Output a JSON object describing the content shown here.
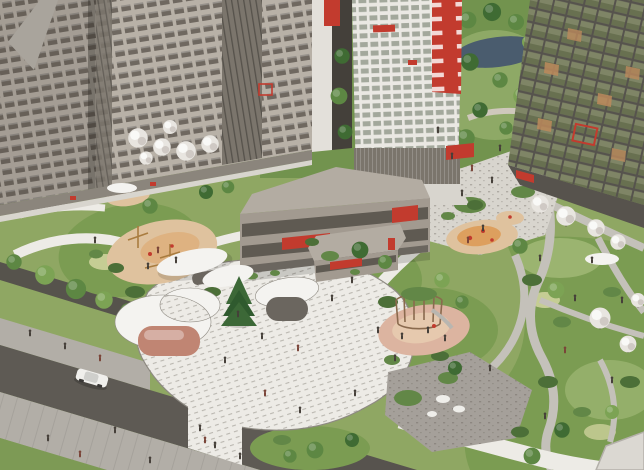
{
  "scene": {
    "label": "Aerial architectural rendering of a residential complex courtyard",
    "elements": [
      "apartment-building-left-cluster",
      "white-tower-with-red-accents",
      "glass-apartment-building-right",
      "parking-podium-building",
      "park-with-lake",
      "courtyard-plaza",
      "sand-playground",
      "orange-playground",
      "climbing-dome-playground",
      "crescent-canopy",
      "white-canopies",
      "pink-pavilion",
      "spruce-tree",
      "blossom-trees",
      "winding-paths",
      "road-with-car",
      "sidewalk-with-pedestrians"
    ]
  },
  "palette": {
    "sky": "#cac8c5",
    "parkGreen": "#72934e",
    "parkTreeDark": "#3f6b33",
    "parkTree": "#5d8743",
    "parkTreeLight": "#7ca354",
    "lake": "#4a5c6e",
    "lawn": "#8fa763",
    "lawnLight": "#aabf7d",
    "moundGreen": "#7b9c52",
    "bushDark": "#4c6f38",
    "bushMid": "#628747",
    "flowerLight": "#d8d9a5",
    "blossom": "#e8e5e0",
    "blossomShade": "#cfc9c4",
    "pathWhite": "#edebe6",
    "pathLight": "#d8d5ce",
    "pathGray": "#c4c1ba",
    "pathEdge": "#8e8a82",
    "plazaGray": "#a5a09a",
    "road": "#5e5a54",
    "sidewalk": "#b2aea7",
    "hedgeWall": "#56534c",
    "facadeBeige": "#b8b1a7",
    "windowDark": "#6f6860",
    "coreDark": "#7b756c",
    "towerWhite": "#eae8e3",
    "towerWindow": "#a3a89c",
    "accentRed": "#c23b2e",
    "glassFrame": "#56534d",
    "glassGreen": "#7f8566",
    "glassGreenDark": "#687050",
    "glassTan": "#bc8a5c",
    "podiumRoof": "#b3aca2",
    "podiumFace": "#a29a90",
    "podiumBand": "#5f5a52",
    "playSand": "#dfc29e",
    "playOrange": "#dd9f5e",
    "playPink": "#dcb4a0",
    "canopyWhite": "#f4f3f0",
    "pavilionPink": "#c08573",
    "pavilionDark": "#6b665f",
    "spruce": "#3c6837",
    "domeBronze": "#8a6a4e",
    "rockWhite": "#efeeea",
    "carBody": "#f0efec",
    "person": "#453f39",
    "personAlt": "#7a4438",
    "whiteRoof": "#dbd8d2",
    "finWhite": "#e3e0da",
    "sliverDark": "#44403a",
    "groundStrip": "#8b857c"
  }
}
